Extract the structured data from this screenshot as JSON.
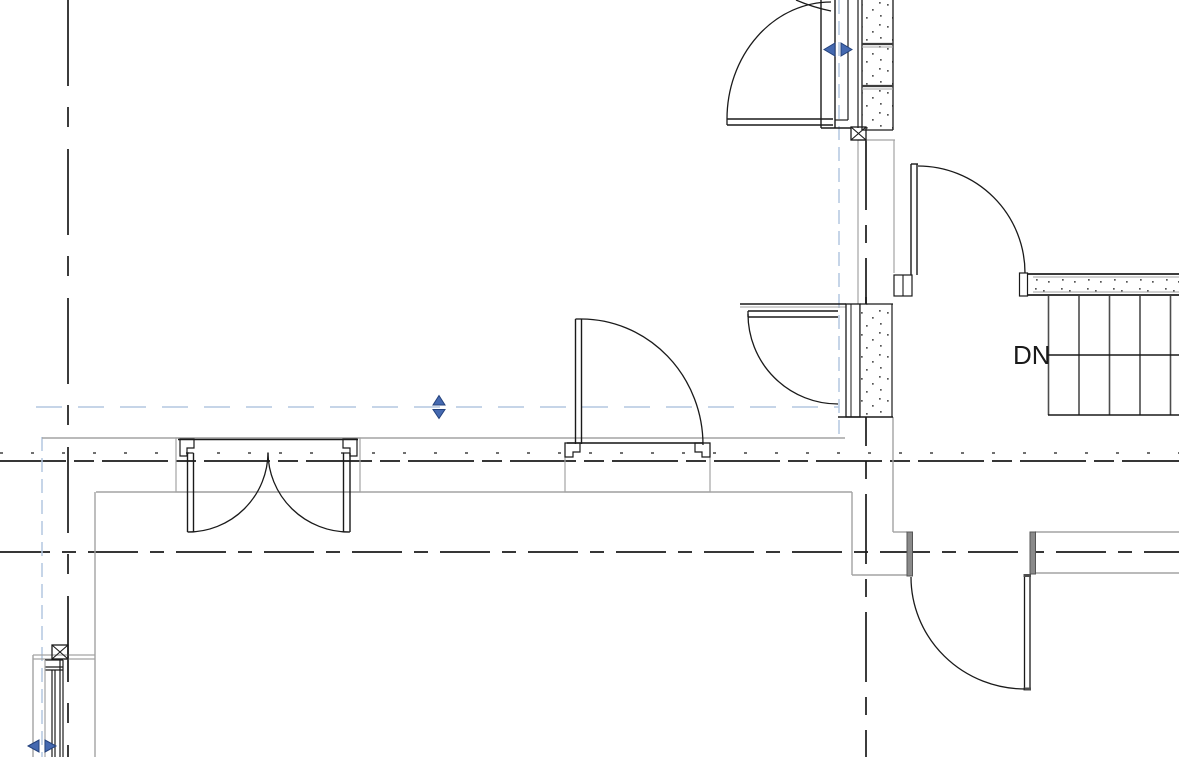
{
  "stairs": {
    "label": "DN",
    "riser_count": 5
  },
  "icons": {
    "flip_horizontal": "flip-arrows-left-right",
    "flip_vertical": "flip-arrows-up-down"
  },
  "colors": {
    "background": "#ffffff",
    "line_black": "#1a1a1a",
    "line_gray": "#a3a3a3",
    "line_dark_gray": "#4d4d4d",
    "reference_blue": "#b4c7e0",
    "flip_arrow_fill": "#4569b0",
    "flip_arrow_stroke": "#24427c",
    "stipple_dot": "#555555",
    "band_line": "#3c3c3c"
  }
}
